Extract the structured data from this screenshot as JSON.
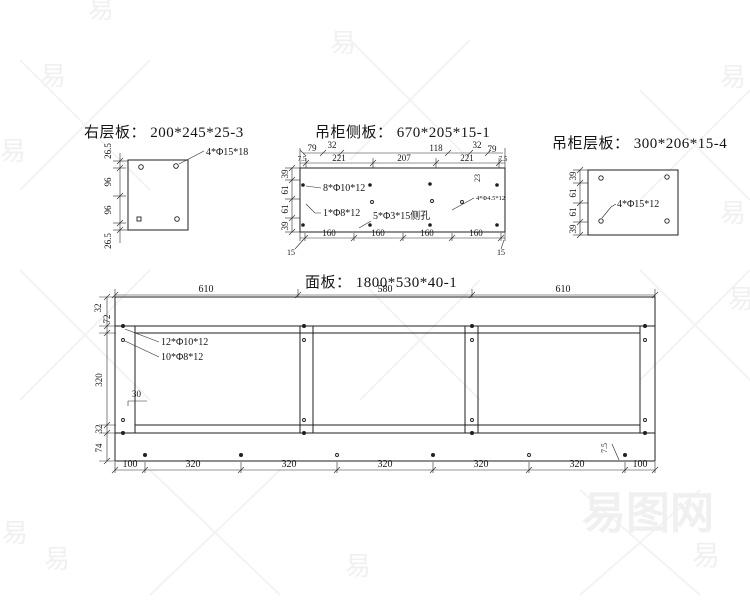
{
  "watermark": {
    "glyph": "易",
    "site_name": "易图网",
    "color": "#f0f0f0"
  },
  "drawing1": {
    "title": "右层板： 200*245*25-3",
    "hole_label": "4*Φ15*18",
    "left_dims": [
      "26.5",
      "96",
      "96",
      "26.5"
    ]
  },
  "drawing2": {
    "title": "吊柜侧板： 670*205*15-1",
    "dims_row1": [
      "79",
      "32",
      "118",
      "32",
      "79"
    ],
    "dims_row2": [
      "7.5",
      "221",
      "207",
      "221",
      "7.5"
    ],
    "left_dims": [
      "39",
      "61",
      "61",
      "39"
    ],
    "bottom_dims": [
      "160",
      "160",
      "160",
      "160"
    ],
    "bottom_edge_dims": [
      "15",
      "15"
    ],
    "hole_labels": {
      "top": "8*Φ10*12",
      "left": "1*Φ8*12",
      "side": "5*Φ3*15侧孔",
      "small": "4*Φ4.5*12",
      "vertical": "23"
    }
  },
  "drawing3": {
    "title": "吊柜层板： 300*206*15-4",
    "hole_label": "4*Φ15*12",
    "left_dims": [
      "39",
      "61",
      "61",
      "39"
    ]
  },
  "drawing4": {
    "title": "面板： 1800*530*40-1",
    "top_dims": [
      "610",
      "580",
      "610"
    ],
    "bottom_dims": [
      "100",
      "320",
      "320",
      "320",
      "320",
      "320",
      "100"
    ],
    "left_dims": [
      "32",
      "72",
      "320",
      "32",
      "74"
    ],
    "inner_dims": {
      "offset": "30",
      "edge": "7.5"
    },
    "hole_labels": {
      "l1": "12*Φ10*12",
      "l2": "10*Φ8*12"
    }
  }
}
